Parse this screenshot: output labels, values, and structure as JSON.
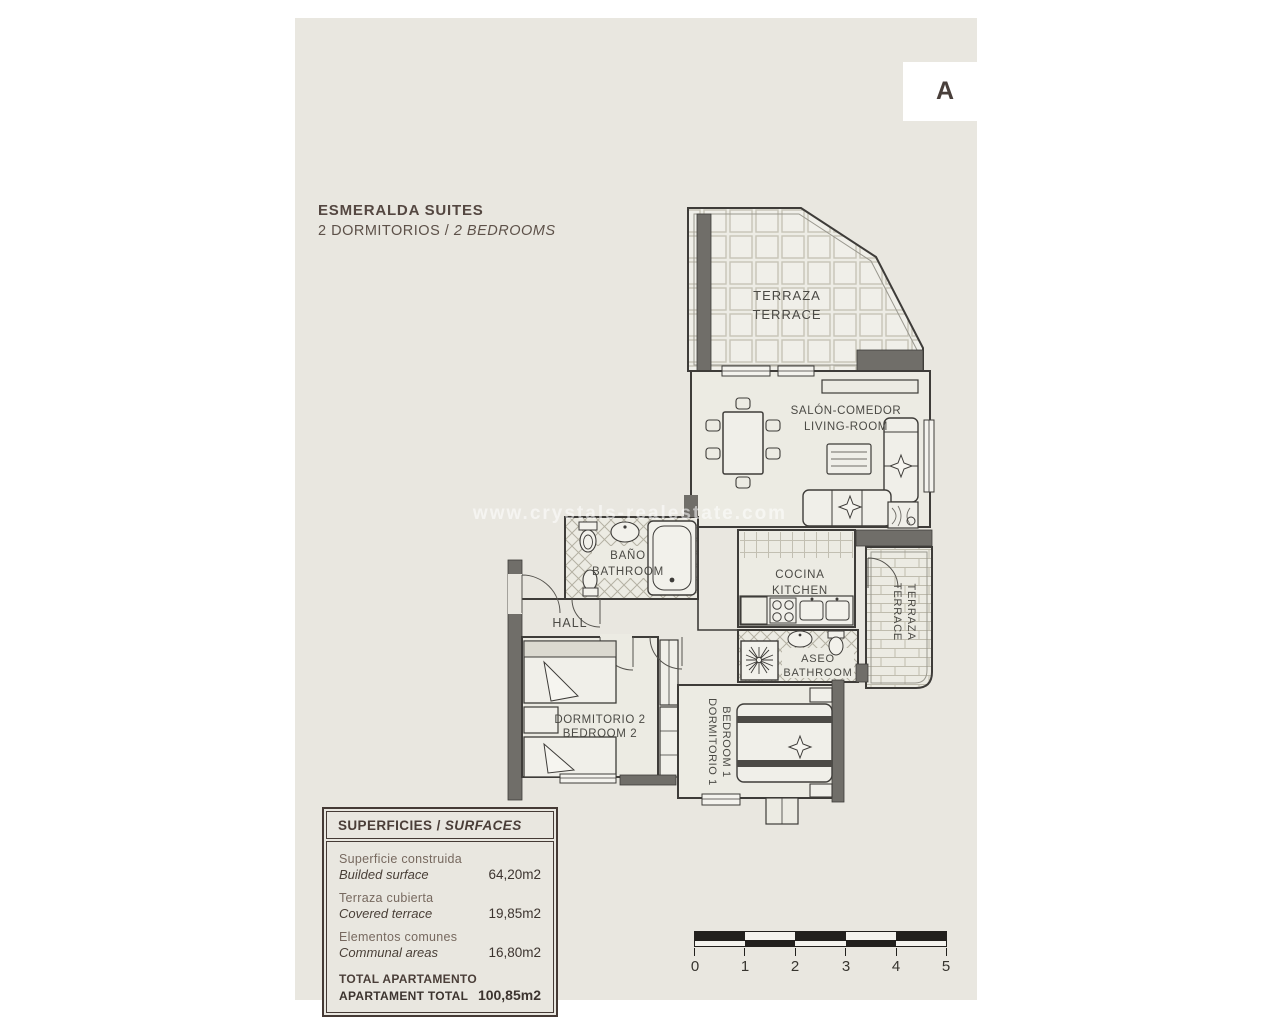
{
  "page": {
    "title_line1": "ESMERALDA SUITES",
    "title_line2_es": "2 DORMITORIOS /",
    "title_line2_en": "2 BEDROOMS",
    "unit_label": "A",
    "watermark": "www.crystals-realestate.com"
  },
  "rooms": {
    "terrace_top": {
      "es": "TERRAZA",
      "en": "TERRACE"
    },
    "living": {
      "es": "SALÓN-COMEDOR",
      "en": "LIVING-ROOM"
    },
    "bathroom": {
      "es": "BAÑO",
      "en": "BATHROOM"
    },
    "kitchen": {
      "es": "COCINA",
      "en": "KITCHEN"
    },
    "hall": {
      "es": "HALL"
    },
    "bedroom2": {
      "es": "DORMITORIO 2",
      "en": "BEDROOM 2"
    },
    "bedroom1": {
      "es": "DORMITORIO 1",
      "en": "BEDROOM 1"
    },
    "aseo": {
      "es": "ASEO",
      "en": "BATHROOM"
    },
    "terrace_side": {
      "es": "TERRAZA",
      "en": "TERRACE"
    }
  },
  "surfaces_table": {
    "header_es": "SUPERFICIES /",
    "header_en": "SURFACES",
    "rows": [
      {
        "label_es": "Superficie construida",
        "label_en": "Builded surface",
        "value": "64,20m2"
      },
      {
        "label_es": "Terraza cubierta",
        "label_en": "Covered terrace",
        "value": "19,85m2"
      },
      {
        "label_es": "Elementos comunes",
        "label_en": "Communal areas",
        "value": "16,80m2"
      }
    ],
    "total": {
      "label_es": "TOTAL APARTAMENTO",
      "label_en": "APARTAMENT TOTAL",
      "value": "100,85m2"
    }
  },
  "scale_bar": {
    "ticks": [
      "0",
      "1",
      "2",
      "3",
      "4",
      "5"
    ]
  },
  "colors": {
    "page_bg": "#ffffff",
    "panel_bg": "#e9e7e0",
    "wall_line": "#3e3c39",
    "wall_fill": "#706e69",
    "text": "#4b4a45",
    "table_border": "#453a35"
  }
}
